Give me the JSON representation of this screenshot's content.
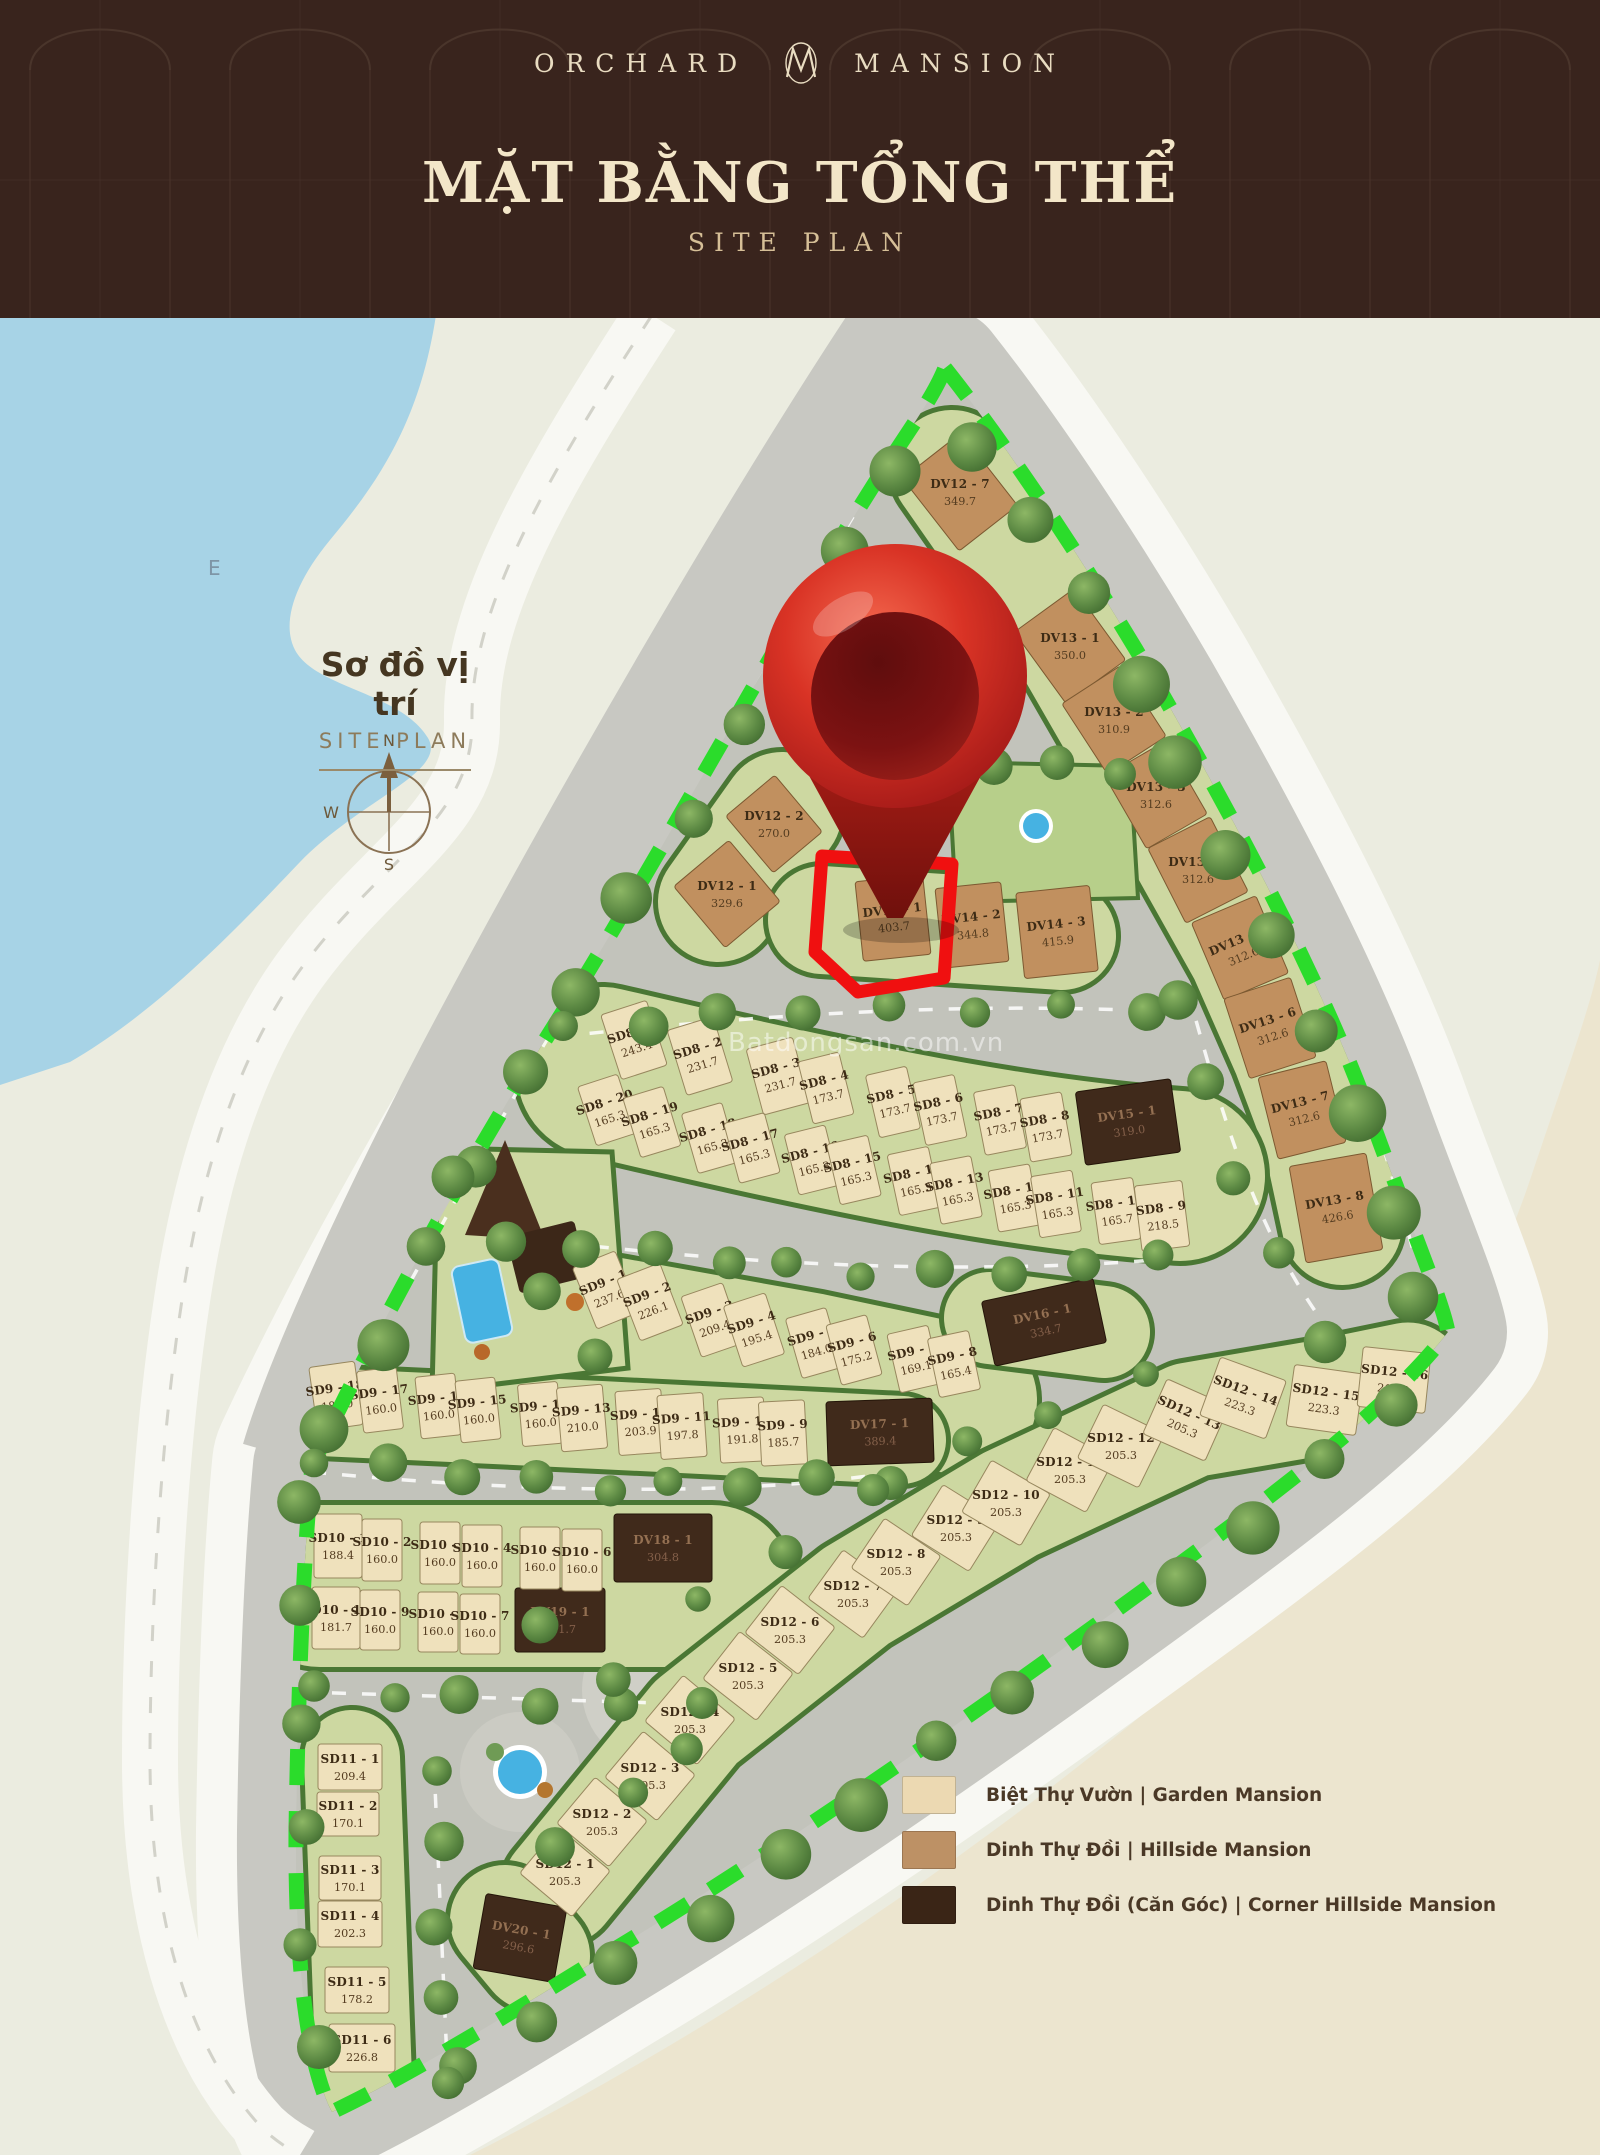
{
  "header": {
    "brand_left": "ORCHARD",
    "brand_right": "MANSION",
    "title": "MẶT BẰNG TỔNG THỂ",
    "subtitle": "SITE PLAN"
  },
  "inset": {
    "title": "Sơ đồ vị trí",
    "subtitle": "SITE PLAN",
    "compass": {
      "n": "N",
      "w": "W",
      "s": "S"
    },
    "water_label": "E"
  },
  "watermark": "Batdongsan.com.vn",
  "legend": {
    "items": [
      {
        "label": "Biệt Thự Vườn | Garden Mansion",
        "color": "#ecd9b2",
        "type": "garden"
      },
      {
        "label": "Dinh Thự Đồi | Hillside Mansion",
        "color": "#bd9165",
        "type": "hillside"
      },
      {
        "label": "Dinh Thự Đồi (Căn Góc) | Corner Hillside Mansion",
        "color": "#3a2516",
        "type": "corner"
      }
    ]
  },
  "map": {
    "colors": {
      "bg": "#ebece0",
      "sand": "#ece5cf",
      "water": "#a7d3e6",
      "road_white": "#f8f8f3",
      "road_gray": "#c8c8c2",
      "site_base": "#c2c3bb",
      "pad": "#cdd8a1",
      "pad_light": "#b7cf8a",
      "hedge": "#4a7734",
      "lot_garden": "#efe1bc",
      "lot_hillside": "#c1905f",
      "lot_corner": "#402a1b",
      "dash": "#2bdc2b",
      "highlight": "#f01010",
      "pin_light": "#f4694f",
      "pin_dark": "#8e1414",
      "pond": "#46b2e2"
    },
    "highlight_lot": "DV14 - 1",
    "highlight_points": "822,856 952,864 944,978 858,992 815,952",
    "pin": {
      "x": 895,
      "bulb_y": 676,
      "r": 132,
      "inner_r": 84,
      "tip_y": 918
    },
    "lot_fields": [
      "id",
      "area",
      "x",
      "y",
      "w",
      "h",
      "rot",
      "type"
    ],
    "lots": [
      [
        "DV12 - 7",
        "349.7",
        960,
        492,
        74,
        92,
        -38,
        "h"
      ],
      [
        "DV13 - 1",
        "350.0",
        1070,
        646,
        74,
        88,
        -36,
        "h"
      ],
      [
        "DV13 - 2",
        "310.9",
        1114,
        720,
        70,
        84,
        -33,
        "h"
      ],
      [
        "DV13 - 3",
        "312.6",
        1156,
        795,
        70,
        84,
        -30,
        "h"
      ],
      [
        "DV13 - 4",
        "312.6",
        1198,
        870,
        70,
        84,
        -27,
        "h"
      ],
      [
        "DV13 - 5",
        "312.6",
        1240,
        948,
        70,
        84,
        -23,
        "h"
      ],
      [
        "DV13 - 6",
        "312.6",
        1270,
        1028,
        70,
        84,
        -18,
        "h"
      ],
      [
        "DV13 - 7",
        "312.6",
        1302,
        1110,
        70,
        84,
        -14,
        "h"
      ],
      [
        "DV13 - 8",
        "426.6",
        1336,
        1208,
        78,
        98,
        -10,
        "h"
      ],
      [
        "DV12 - 2",
        "270.0",
        774,
        824,
        64,
        74,
        -40,
        "h"
      ],
      [
        "DV12 - 1",
        "329.6",
        727,
        894,
        72,
        80,
        -40,
        "h"
      ],
      [
        "DV14 - 1",
        "403.7",
        893,
        918,
        68,
        80,
        -6,
        "h"
      ],
      [
        "DV14 - 2",
        "344.8",
        972,
        925,
        66,
        80,
        -6,
        "h"
      ],
      [
        "DV14 - 3",
        "415.9",
        1057,
        932,
        74,
        86,
        -6,
        "h"
      ],
      [
        "DV15 - 1",
        "319.0",
        1128,
        1122,
        96,
        74,
        -8,
        "c"
      ],
      [
        "DV16 - 1",
        "334.7",
        1044,
        1322,
        114,
        66,
        -12,
        "c"
      ],
      [
        "DV17 - 1",
        "389.4",
        880,
        1432,
        106,
        64,
        -2,
        "c"
      ],
      [
        "DV18 - 1",
        "304.8",
        663,
        1548,
        98,
        68,
        0,
        "c"
      ],
      [
        "DV19 - 1",
        "311.7",
        560,
        1620,
        90,
        64,
        0,
        "c"
      ],
      [
        "DV20 - 1",
        "296.6",
        520,
        1938,
        82,
        76,
        10,
        "c"
      ],
      [
        "SD8 - 1",
        "243.4",
        634,
        1040,
        48,
        68,
        -18,
        "g"
      ],
      [
        "SD8 - 2",
        "231.7",
        700,
        1056,
        48,
        68,
        -17,
        "g"
      ],
      [
        "SD8 - 3",
        "231.7",
        778,
        1076,
        48,
        68,
        -15,
        "g"
      ],
      [
        "SD8 - 4",
        "173.7",
        826,
        1088,
        42,
        64,
        -14,
        "g"
      ],
      [
        "SD8 - 5",
        "173.7",
        893,
        1102,
        42,
        64,
        -13,
        "g"
      ],
      [
        "SD8 - 6",
        "173.7",
        940,
        1110,
        42,
        64,
        -12,
        "g"
      ],
      [
        "SD8 - 7",
        "173.7",
        1000,
        1120,
        42,
        64,
        -11,
        "g"
      ],
      [
        "SD8 - 8",
        "173.7",
        1046,
        1127,
        42,
        64,
        -10,
        "g"
      ],
      [
        "SD8 - 20",
        "165.3",
        607,
        1110,
        42,
        62,
        -18,
        "g"
      ],
      [
        "SD8 - 19",
        "165.3",
        652,
        1122,
        42,
        62,
        -17,
        "g"
      ],
      [
        "SD8 - 18",
        "165.3",
        710,
        1138,
        42,
        62,
        -16,
        "g"
      ],
      [
        "SD8 - 17",
        "165.3",
        752,
        1148,
        42,
        62,
        -15,
        "g"
      ],
      [
        "SD8 - 16",
        "165.3",
        812,
        1160,
        42,
        62,
        -14,
        "g"
      ],
      [
        "SD8 - 15",
        "165.3",
        854,
        1170,
        42,
        62,
        -13,
        "g"
      ],
      [
        "SD8 - 14",
        "165.3",
        914,
        1181,
        42,
        62,
        -12,
        "g"
      ],
      [
        "SD8 - 13",
        "165.3",
        956,
        1190,
        42,
        62,
        -11,
        "g"
      ],
      [
        "SD8 - 12",
        "165.3",
        1014,
        1198,
        42,
        62,
        -10,
        "g"
      ],
      [
        "SD8 - 11",
        "165.3",
        1056,
        1204,
        42,
        62,
        -9,
        "g"
      ],
      [
        "SD8 - 10",
        "165.7",
        1116,
        1211,
        42,
        62,
        -8,
        "g"
      ],
      [
        "SD8 - 9",
        "218.5",
        1162,
        1216,
        48,
        66,
        -7,
        "g"
      ],
      [
        "SD9 - 1",
        "237.6",
        606,
        1290,
        46,
        66,
        -22,
        "g"
      ],
      [
        "SD9 - 2",
        "226.1",
        650,
        1302,
        46,
        66,
        -21,
        "g"
      ],
      [
        "SD9 - 3",
        "209.4",
        712,
        1320,
        44,
        64,
        -19,
        "g"
      ],
      [
        "SD9 - 4",
        "195.4",
        754,
        1330,
        44,
        64,
        -18,
        "g"
      ],
      [
        "SD9 - 5",
        "184.0",
        814,
        1343,
        42,
        62,
        -16,
        "g"
      ],
      [
        "SD9 - 6",
        "175.2",
        854,
        1350,
        42,
        62,
        -15,
        "g"
      ],
      [
        "SD9 - 7",
        "169.1",
        914,
        1359,
        42,
        60,
        -13,
        "g"
      ],
      [
        "SD9 - 8",
        "165.4",
        954,
        1364,
        42,
        60,
        -12,
        "g"
      ],
      [
        "SD9 - 18",
        "182.0",
        336,
        1396,
        46,
        64,
        -8,
        "g"
      ],
      [
        "SD9 - 17",
        "160.0",
        380,
        1400,
        40,
        62,
        -7,
        "g"
      ],
      [
        "SD9 - 16",
        "160.0",
        438,
        1406,
        40,
        62,
        -6,
        "g"
      ],
      [
        "SD9 - 15",
        "160.0",
        478,
        1410,
        40,
        62,
        -6,
        "g"
      ],
      [
        "SD9 - 14",
        "160.0",
        540,
        1414,
        40,
        62,
        -5,
        "g"
      ],
      [
        "SD9 - 13",
        "210.0",
        582,
        1418,
        46,
        64,
        -5,
        "g"
      ],
      [
        "SD9 - 12",
        "203.9",
        640,
        1422,
        46,
        64,
        -4,
        "g"
      ],
      [
        "SD9 - 11",
        "197.8",
        682,
        1426,
        46,
        64,
        -4,
        "g"
      ],
      [
        "SD9 - 10",
        "191.8",
        742,
        1430,
        46,
        64,
        -3,
        "g"
      ],
      [
        "SD9 - 9",
        "185.7",
        783,
        1433,
        46,
        64,
        -3,
        "g"
      ],
      [
        "SD10 - 1",
        "188.4",
        338,
        1546,
        48,
        64,
        0,
        "g"
      ],
      [
        "SD10 - 2",
        "160.0",
        382,
        1550,
        40,
        62,
        0,
        "g"
      ],
      [
        "SD10 - 3",
        "160.0",
        440,
        1553,
        40,
        62,
        0,
        "g"
      ],
      [
        "SD10 - 4",
        "160.0",
        482,
        1556,
        40,
        62,
        0,
        "g"
      ],
      [
        "SD10 - 5",
        "160.0",
        540,
        1558,
        40,
        62,
        0,
        "g"
      ],
      [
        "SD10 - 6",
        "160.0",
        582,
        1560,
        40,
        62,
        0,
        "g"
      ],
      [
        "SD10 - 10",
        "181.7",
        336,
        1618,
        48,
        62,
        0,
        "g"
      ],
      [
        "SD10 - 9",
        "160.0",
        380,
        1620,
        40,
        60,
        0,
        "g"
      ],
      [
        "SD10 - 8",
        "160.0",
        438,
        1622,
        40,
        60,
        0,
        "g"
      ],
      [
        "SD10 - 7",
        "160.0",
        480,
        1624,
        40,
        60,
        0,
        "g"
      ],
      [
        "SD11 - 1",
        "209.4",
        350,
        1767,
        64,
        46,
        0,
        "g"
      ],
      [
        "SD11 - 2",
        "170.1",
        348,
        1814,
        62,
        44,
        0,
        "g"
      ],
      [
        "SD11 - 3",
        "170.1",
        350,
        1878,
        62,
        44,
        0,
        "g"
      ],
      [
        "SD11 - 4",
        "202.3",
        350,
        1924,
        64,
        46,
        0,
        "g"
      ],
      [
        "SD11 - 5",
        "178.2",
        357,
        1990,
        64,
        46,
        0,
        "g"
      ],
      [
        "SD11 - 6",
        "226.8",
        362,
        2048,
        66,
        48,
        0,
        "g"
      ],
      [
        "SD12 - 1",
        "205.3",
        565,
        1872,
        68,
        60,
        40,
        "g"
      ],
      [
        "SD12 - 2",
        "205.3",
        602,
        1822,
        68,
        60,
        40,
        "g"
      ],
      [
        "SD12 - 3",
        "205.3",
        650,
        1776,
        68,
        60,
        40,
        "g"
      ],
      [
        "SD12 - 4",
        "205.3",
        690,
        1720,
        68,
        60,
        40,
        "g"
      ],
      [
        "SD12 - 5",
        "205.3",
        748,
        1676,
        68,
        60,
        38,
        "g"
      ],
      [
        "SD12 - 6",
        "205.3",
        790,
        1630,
        68,
        60,
        38,
        "g"
      ],
      [
        "SD12 - 7",
        "205.3",
        853,
        1594,
        68,
        60,
        36,
        "g"
      ],
      [
        "SD12 - 8",
        "205.3",
        896,
        1562,
        68,
        60,
        34,
        "g"
      ],
      [
        "SD12 - 9",
        "205.3",
        956,
        1528,
        68,
        60,
        32,
        "g"
      ],
      [
        "SD12 - 10",
        "205.3",
        1006,
        1503,
        68,
        60,
        30,
        "g"
      ],
      [
        "SD12 - 11",
        "205.3",
        1070,
        1470,
        68,
        60,
        28,
        "g"
      ],
      [
        "SD12 - 12",
        "205.3",
        1121,
        1446,
        68,
        60,
        26,
        "g"
      ],
      [
        "SD12 - 13",
        "205.3",
        1186,
        1420,
        68,
        60,
        24,
        "g"
      ],
      [
        "SD12 - 14",
        "223.3",
        1243,
        1398,
        70,
        62,
        20,
        "g"
      ],
      [
        "SD12 - 15",
        "223.3",
        1325,
        1400,
        70,
        62,
        8,
        "g"
      ],
      [
        "SD12 - 16",
        "219.4",
        1394,
        1380,
        68,
        60,
        6,
        "g"
      ]
    ]
  }
}
